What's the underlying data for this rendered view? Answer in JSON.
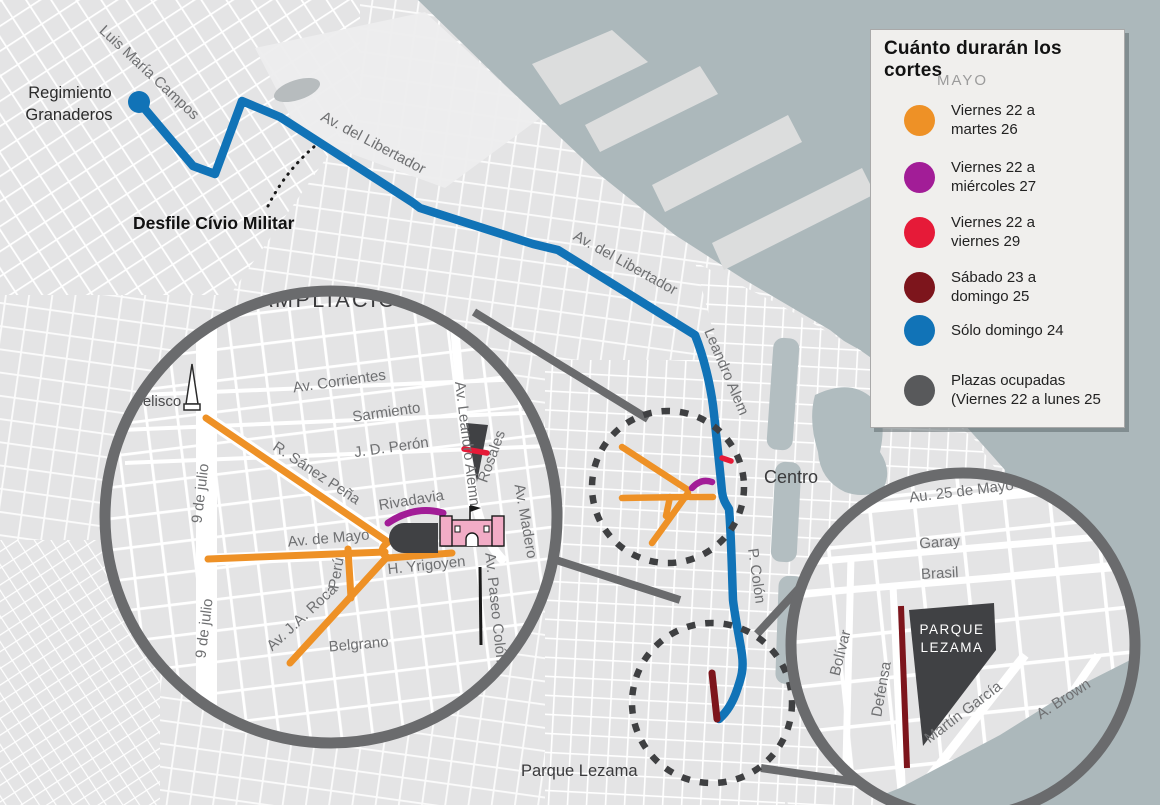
{
  "legend": {
    "title": "Cuánto durarán los cortes",
    "month": "MAYO",
    "items": [
      {
        "color": "#EE9126",
        "line1": "Viernes 22 a",
        "line2": "martes 26"
      },
      {
        "color": "#A21D97",
        "line1": "Viernes 22 a",
        "line2": "miércoles 27"
      },
      {
        "color": "#E61A38",
        "line1": "Viernes 22 a",
        "line2": "viernes 29"
      },
      {
        "color": "#7D151C",
        "line1": "Sábado 23 a",
        "line2": "domingo 25"
      },
      {
        "color": "#1173B7",
        "line1": "Sólo domingo 24",
        "line2": ""
      },
      {
        "color": "#58595B",
        "line1": "Plazas ocupadas",
        "line2": "(Viernes 22 a lunes 25"
      }
    ]
  },
  "main_map": {
    "labels": {
      "regimiento_line1": "Regimiento",
      "regimiento_line2": "Granaderos",
      "luis_maria_campos": "Luis María Campos",
      "desfile": "Desfile Cívio Militar",
      "libertador_nw": "Av. del Libertador",
      "libertador_c": "Av. del Libertador",
      "leandro_alem": "Leandro Alem",
      "centro": "Centro",
      "p_colon": "P. Colón",
      "parque_lezama": "Parque Lezama"
    }
  },
  "ampliacion": {
    "title": "AMPLIACIÓN",
    "labels": {
      "obelisco": "Obelisco",
      "corrientes": "Av. Corrientes",
      "sarmiento": "Sarmiento",
      "peron": "J. D. Perón",
      "saenz_pena": "R. Sánez Peña",
      "nueve_de_julio_n": "9 de julio",
      "nueve_de_julio_s": "9 de julio",
      "av_de_mayo": "Av. de Mayo",
      "rivadavia": "Rivadavia",
      "peru": "Perú",
      "roca": "Av. J.A. Roca",
      "belgrano": "Belgrano",
      "yrigoyen": "H. Yrigoyen",
      "leandro_alem": "Av. Leandro Alemn",
      "rosales": "Rosales",
      "madero": "Av. Madero",
      "paseo_colon": "Av. Paseo Colón"
    }
  },
  "lezama": {
    "labels": {
      "au_25_mayo": "Au. 25 de Mayo",
      "garay": "Garay",
      "brasil": "Brasil",
      "bolivar": "Bolívar",
      "defensa": "Defensa",
      "parque_line1": "PARQUE",
      "parque_line2": "LEZAMA",
      "martin_garcia": "Martín García",
      "brown": "A. Brown"
    }
  },
  "colors": {
    "water": "#ACB8BB",
    "land": "#E4E4E5",
    "route_blue": "#1173B7",
    "orange": "#EE9126",
    "magenta": "#A21D97",
    "red": "#E61A38",
    "dark_red": "#7D151C",
    "occupied_gray": "#58595B",
    "plaza_dark": "#404144",
    "callout_gray": "#6A6B6D",
    "dashed_dark": "#3F4042",
    "dock_water": "#B3BEC1"
  }
}
